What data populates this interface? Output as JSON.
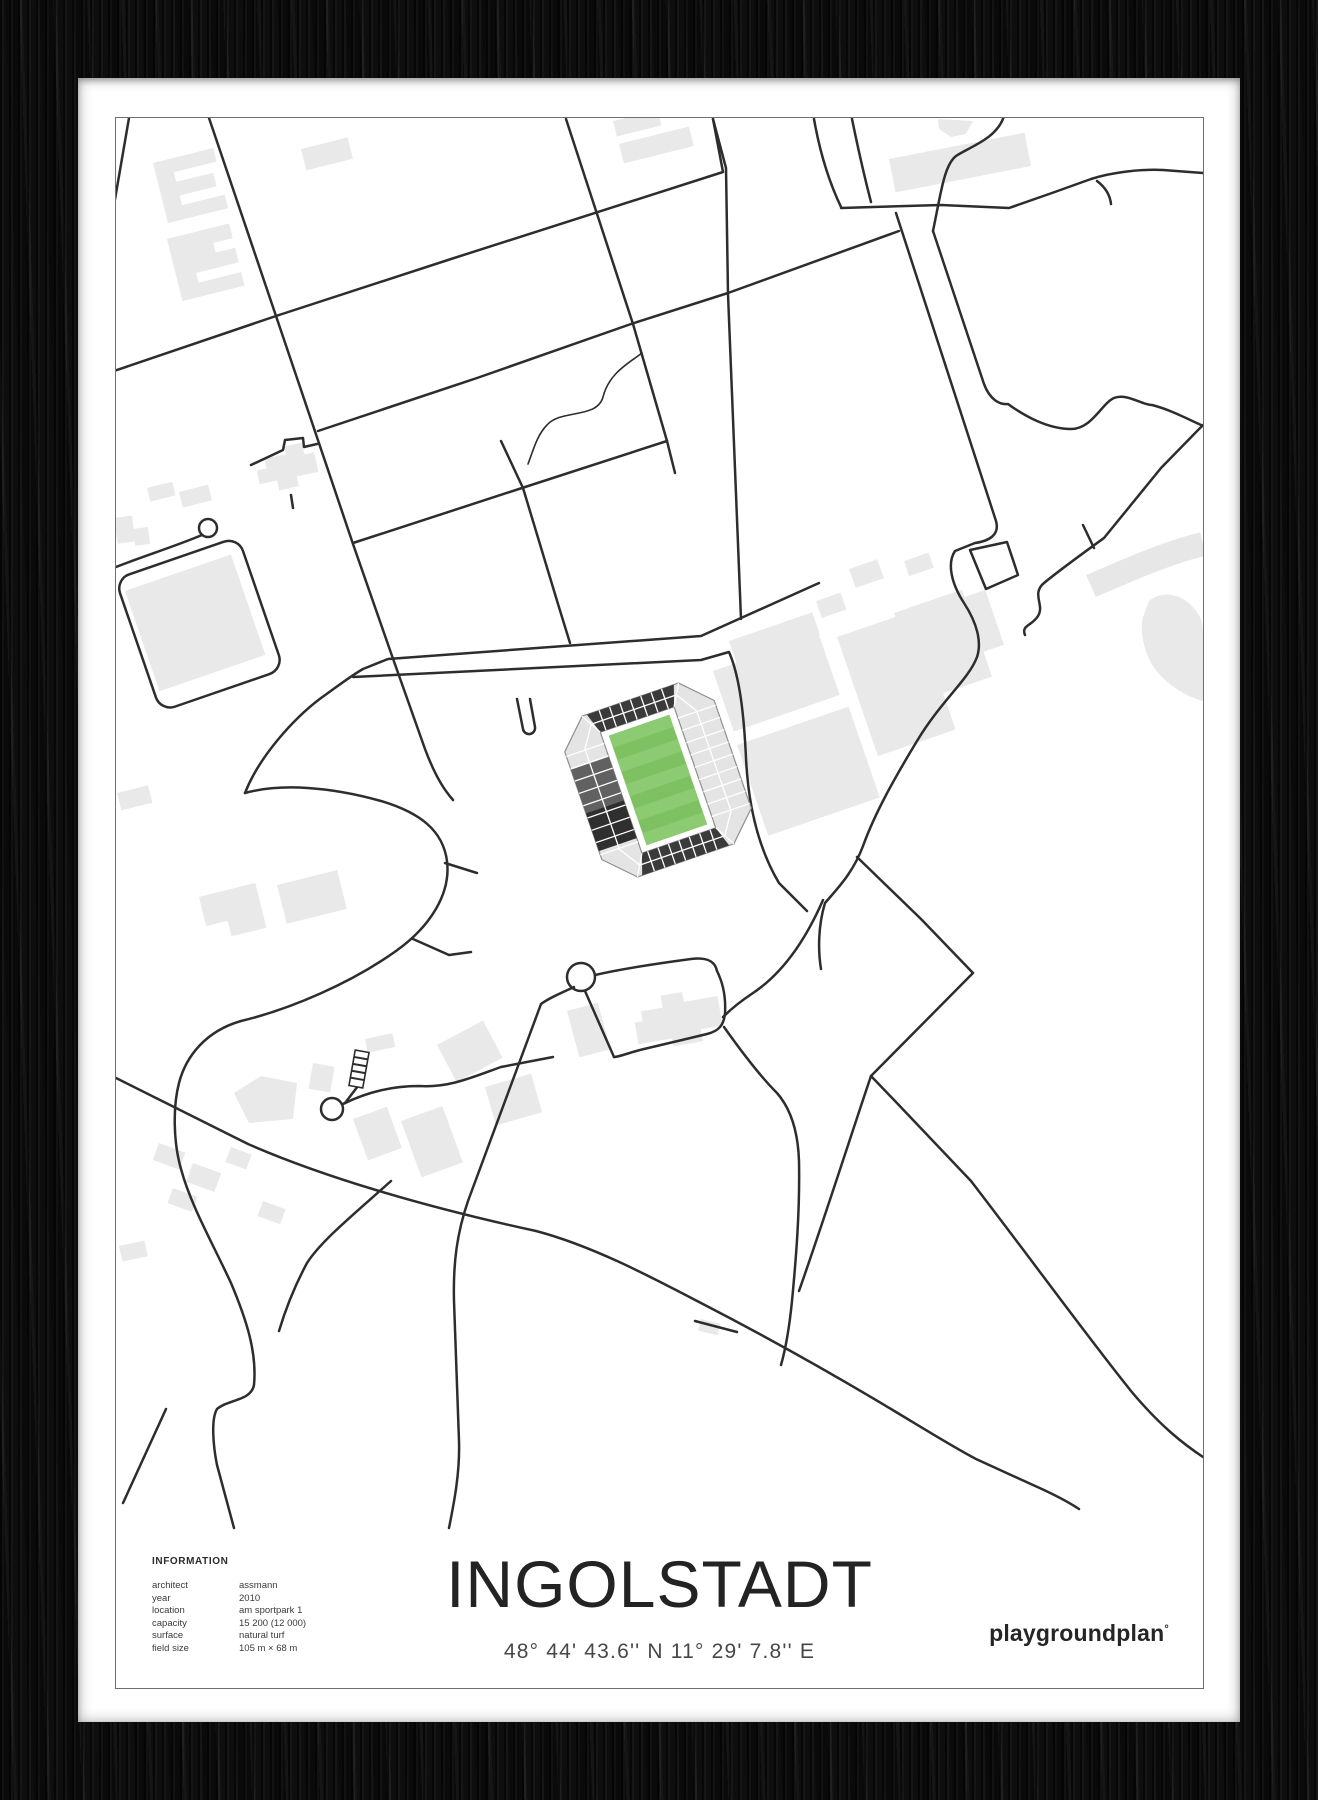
{
  "poster": {
    "title": "INGOLSTADT",
    "coordinates": "48° 44' 43.6'' N  11° 29' 7.8'' E",
    "brand": "playgroundplan",
    "brand_mark": "°",
    "info": {
      "heading": "INFORMATION",
      "rows": [
        {
          "label": "architect",
          "value": "assmann"
        },
        {
          "label": "year",
          "value": "2010"
        },
        {
          "label": "location",
          "value": "am sportpark 1"
        },
        {
          "label": "capacity",
          "value": "15 200 (12 000)"
        },
        {
          "label": "surface",
          "value": "natural turf"
        },
        {
          "label": "field size",
          "value": "105 m × 68 m"
        }
      ]
    },
    "map": {
      "stadium_name_implied": "Audi Sportpark",
      "colors": {
        "road": "#2d2d2d",
        "building": "#e9e9e9",
        "pitch_dark": "#7dc163",
        "pitch_light": "#8ccb72",
        "stand_light": "#e4e4e4",
        "stand_dark": "#3a3a3a",
        "stand_mid": "#616161",
        "frame": "#141414"
      }
    }
  }
}
